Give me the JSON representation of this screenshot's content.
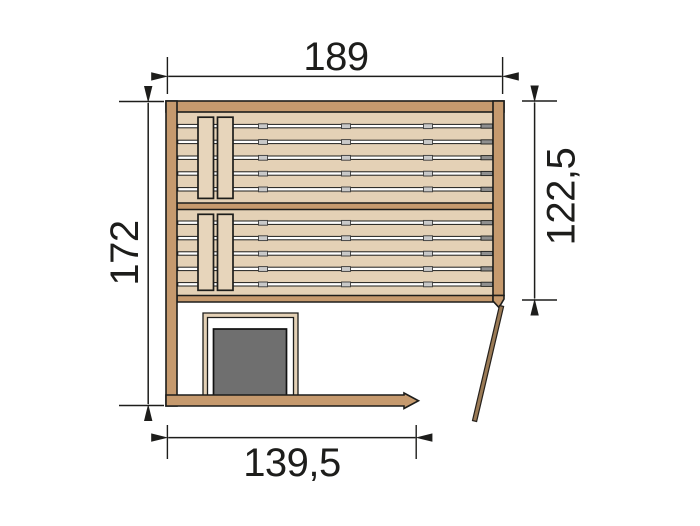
{
  "page": {
    "background": "#ffffff",
    "description": "Technical top-view floor plan of a corner sauna: two slatted benches, heater with guard rail, open door, and four dimension annotations"
  },
  "drawing": {
    "dimension_labels": {
      "top": "189",
      "left": "172",
      "right": "122,5",
      "bottom": "139,5"
    }
  },
  "colors": {
    "background": "#ffffff",
    "line": "#1d1d1b",
    "wall": "#c69a6e",
    "bench": "#e4d1b6",
    "slat": "#e7d5bb",
    "slit": "#ffffff",
    "joint": "#c9c9c9",
    "cap": "#8f8f8f",
    "guard": "#e4d1b6",
    "heater": "#6f6f6f",
    "door": "#9a7a55"
  }
}
